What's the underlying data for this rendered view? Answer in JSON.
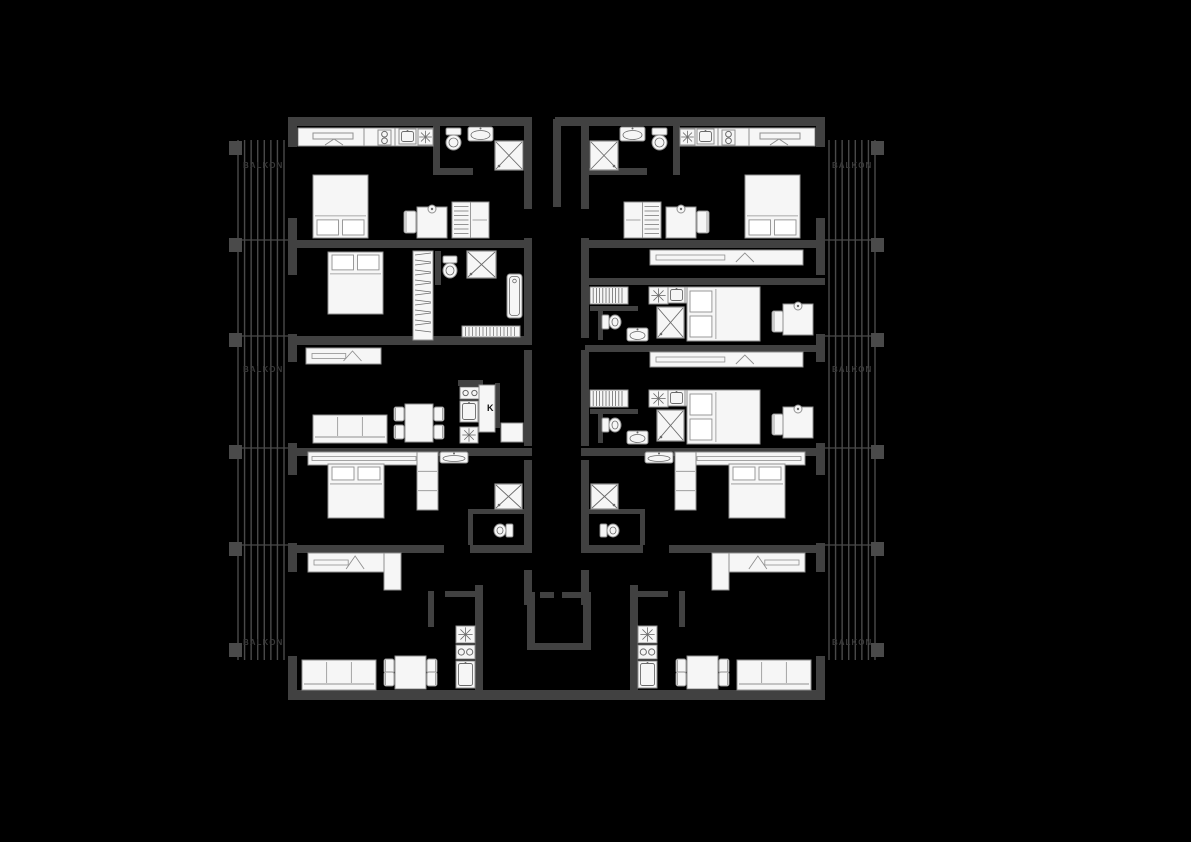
{
  "canvas": {
    "width": 1191,
    "height": 842,
    "background": "#000000"
  },
  "colors": {
    "wall": "#414141",
    "furniture_fill": "#f6f6f6",
    "furniture_stroke": "#909090",
    "detail": "#6a6a6a",
    "balcony_line": "#4a4a4a",
    "balcony_pier": "#4a4a4a",
    "faint_text": "#3a3a3a",
    "label_text": "#111111"
  },
  "mirror_sum": 1113,
  "balcony": {
    "x": 233,
    "y": 140,
    "w": 56,
    "h": 520,
    "n_lines": 8,
    "dividers": [
      240,
      336,
      448,
      545
    ],
    "piers_y": [
      141,
      238,
      333,
      445,
      542,
      643
    ],
    "labels": [
      {
        "text": "BALKON",
        "y": 168
      },
      {
        "text": "BALKON",
        "y": 372
      },
      {
        "text": "BALKON",
        "y": 645
      }
    ],
    "m": 1
  },
  "walls": [
    [
      288,
      117,
      244,
      9,
      1
    ],
    [
      555,
      117,
      30,
      9,
      0
    ],
    [
      288,
      240,
      244,
      8,
      1
    ],
    [
      288,
      336,
      244,
      9,
      0
    ],
    [
      288,
      448,
      244,
      8,
      1
    ],
    [
      288,
      545,
      156,
      8,
      1
    ],
    [
      470,
      545,
      62,
      8,
      1
    ],
    [
      288,
      690,
      537,
      10,
      0
    ],
    [
      288,
      117,
      9,
      30,
      1
    ],
    [
      288,
      218,
      9,
      57,
      1
    ],
    [
      288,
      334,
      9,
      28,
      1
    ],
    [
      288,
      443,
      9,
      32,
      1
    ],
    [
      288,
      543,
      9,
      29,
      1
    ],
    [
      288,
      656,
      9,
      44,
      1
    ],
    [
      524,
      117,
      8,
      92,
      1
    ],
    [
      524,
      238,
      8,
      100,
      1
    ],
    [
      524,
      350,
      8,
      96,
      1
    ],
    [
      524,
      460,
      8,
      92,
      1
    ],
    [
      524,
      570,
      8,
      35,
      1
    ],
    [
      433,
      117,
      7,
      58,
      1
    ],
    [
      433,
      168,
      40,
      7,
      0
    ],
    [
      585,
      168,
      62,
      7,
      0
    ],
    [
      435,
      251,
      6,
      34,
      0
    ],
    [
      458,
      380,
      25,
      6,
      0
    ],
    [
      495,
      383,
      5,
      45,
      0
    ],
    [
      468,
      509,
      58,
      5,
      1
    ],
    [
      468,
      514,
      5,
      31,
      1
    ],
    [
      445,
      591,
      32,
      6,
      1
    ],
    [
      428,
      591,
      6,
      36,
      1
    ],
    [
      475,
      585,
      8,
      115,
      1
    ],
    [
      585,
      278,
      240,
      7,
      0
    ],
    [
      585,
      345,
      240,
      7,
      0
    ],
    [
      590,
      306,
      48,
      5,
      0
    ],
    [
      598,
      311,
      5,
      29,
      0
    ],
    [
      590,
      409,
      48,
      5,
      0
    ],
    [
      598,
      414,
      5,
      29,
      0
    ],
    [
      553,
      119,
      8,
      88,
      0
    ],
    [
      527,
      592,
      8,
      57,
      0
    ],
    [
      583,
      592,
      8,
      57,
      0
    ],
    [
      527,
      643,
      64,
      7,
      0
    ],
    [
      540,
      592,
      14,
      6,
      0
    ],
    [
      562,
      592,
      21,
      6,
      0
    ]
  ],
  "furniture": [
    {
      "t": "counter",
      "x": 298,
      "y": 128,
      "w": 135,
      "h": 18,
      "divs": [
        66,
        97
      ],
      "m": 1
    },
    {
      "t": "slot",
      "x": 313,
      "y": 133,
      "w": 40,
      "h": 6,
      "m": 1
    },
    {
      "t": "chevron",
      "x": 325,
      "y": 139,
      "w": 18,
      "h": 6,
      "m": 1
    },
    {
      "t": "burners",
      "x": 378,
      "y": 130,
      "w": 13,
      "h": 15,
      "layout": "v",
      "m": 1
    },
    {
      "t": "sinkbox",
      "x": 399,
      "y": 129,
      "w": 17,
      "h": 15,
      "m": 1
    },
    {
      "t": "star",
      "x": 418,
      "y": 129,
      "w": 15,
      "h": 16,
      "m": 1
    },
    {
      "t": "bed",
      "x": 313,
      "y": 175,
      "w": 55,
      "h": 63,
      "head": "bottom",
      "m": 1
    },
    {
      "t": "chair",
      "x": 404,
      "y": 211,
      "w": 12,
      "h": 22,
      "m": 1
    },
    {
      "t": "desk",
      "x": 417,
      "y": 207,
      "w": 30,
      "h": 31,
      "m": 1
    },
    {
      "t": "wardrobe",
      "x": 452,
      "y": 202,
      "w": 37,
      "h": 36,
      "style": "hang",
      "m": 1
    },
    {
      "t": "toilet",
      "x": 445,
      "y": 128,
      "w": 17,
      "h": 24,
      "orient": "down",
      "m": 1
    },
    {
      "t": "sink",
      "x": 468,
      "y": 127,
      "w": 25,
      "h": 14,
      "m": 1
    },
    {
      "t": "shower",
      "x": 495,
      "y": 141,
      "w": 28,
      "h": 29,
      "m": 1
    },
    {
      "t": "bed",
      "x": 328,
      "y": 252,
      "w": 55,
      "h": 62,
      "head": "top",
      "m": 0
    },
    {
      "t": "wardrobe",
      "x": 413,
      "y": 251,
      "w": 20,
      "h": 89,
      "style": "zigzag",
      "m": 0
    },
    {
      "t": "toilet",
      "x": 442,
      "y": 256,
      "w": 16,
      "h": 24,
      "orient": "down",
      "m": 0
    },
    {
      "t": "shower",
      "x": 467,
      "y": 251,
      "w": 29,
      "h": 27,
      "m": 0
    },
    {
      "t": "bathtub",
      "x": 507,
      "y": 274,
      "w": 15,
      "h": 44,
      "m": 0
    },
    {
      "t": "radiator",
      "x": 462,
      "y": 326,
      "w": 58,
      "h": 11,
      "m": 0
    },
    {
      "t": "sideboard",
      "x": 306,
      "y": 348,
      "w": 75,
      "h": 16,
      "chev": 1,
      "m": 0
    },
    {
      "t": "sofa",
      "x": 313,
      "y": 415,
      "w": 74,
      "h": 28,
      "back": "bottom",
      "m": 0
    },
    {
      "t": "table",
      "x": 405,
      "y": 404,
      "w": 28,
      "h": 38,
      "m": 0
    },
    {
      "t": "burners",
      "x": 460,
      "y": 387,
      "w": 20,
      "h": 12,
      "layout": "h",
      "m": 0
    },
    {
      "t": "sinkbox",
      "x": 460,
      "y": 401,
      "w": 18,
      "h": 21,
      "m": 0
    },
    {
      "t": "star",
      "x": 460,
      "y": 427,
      "w": 18,
      "h": 16,
      "m": 0
    },
    {
      "t": "fridge",
      "x": 479,
      "y": 385,
      "w": 16,
      "h": 47,
      "m": 0
    },
    {
      "t": "box",
      "x": 501,
      "y": 423,
      "w": 22,
      "h": 19,
      "m": 0
    },
    {
      "t": "shelf",
      "x": 308,
      "y": 452,
      "w": 112,
      "h": 13,
      "m": 1
    },
    {
      "t": "bed",
      "x": 328,
      "y": 464,
      "w": 56,
      "h": 54,
      "head": "top",
      "m": 1
    },
    {
      "t": "wardrobe",
      "x": 417,
      "y": 452,
      "w": 21,
      "h": 58,
      "style": "cells",
      "m": 1
    },
    {
      "t": "sink",
      "x": 440,
      "y": 452,
      "w": 28,
      "h": 11,
      "m": 1
    },
    {
      "t": "shower",
      "x": 495,
      "y": 484,
      "w": 27,
      "h": 25,
      "m": 1
    },
    {
      "t": "toilet",
      "x": 492,
      "y": 523,
      "w": 21,
      "h": 15,
      "orient": "left",
      "m": 1
    },
    {
      "t": "sideboard",
      "x": 308,
      "y": 553,
      "w": 76,
      "h": 19,
      "chev": 1,
      "m": 1
    },
    {
      "t": "box",
      "x": 384,
      "y": 553,
      "w": 17,
      "h": 37,
      "m": 1
    },
    {
      "t": "sofa",
      "x": 302,
      "y": 660,
      "w": 74,
      "h": 30,
      "back": "bottom",
      "m": 1
    },
    {
      "t": "table",
      "x": 395,
      "y": 656,
      "w": 31,
      "h": 33,
      "m": 1
    },
    {
      "t": "star",
      "x": 456,
      "y": 626,
      "w": 19,
      "h": 17,
      "m": 1
    },
    {
      "t": "burners",
      "x": 456,
      "y": 645,
      "w": 19,
      "h": 14,
      "layout": "h",
      "m": 1
    },
    {
      "t": "sinkbox",
      "x": 456,
      "y": 661,
      "w": 19,
      "h": 27,
      "m": 1
    },
    {
      "t": "sideboard",
      "x": 650,
      "y": 250,
      "w": 153,
      "h": 15,
      "chev": 1,
      "m": 0
    },
    {
      "t": "sideboard",
      "x": 650,
      "y": 352,
      "w": 153,
      "h": 15,
      "chev": 1,
      "m": 0
    },
    {
      "t": "coatrack",
      "x": 590,
      "y": 287,
      "w": 38,
      "h": 17,
      "m": 0
    },
    {
      "t": "toilet",
      "x": 602,
      "y": 314,
      "w": 21,
      "h": 16,
      "orient": "right",
      "m": 0
    },
    {
      "t": "sink",
      "x": 627,
      "y": 328,
      "w": 21,
      "h": 13,
      "m": 0
    },
    {
      "t": "shower",
      "x": 657,
      "y": 307,
      "w": 27,
      "h": 31,
      "m": 0
    },
    {
      "t": "star",
      "x": 649,
      "y": 287,
      "w": 19,
      "h": 17,
      "m": 0
    },
    {
      "t": "sinkbox",
      "x": 668,
      "y": 287,
      "w": 17,
      "h": 16,
      "m": 0
    },
    {
      "t": "burners",
      "x": 685,
      "y": 287,
      "w": 13,
      "h": 16,
      "layout": "v",
      "m": 0
    },
    {
      "t": "bed",
      "x": 687,
      "y": 287,
      "w": 73,
      "h": 54,
      "head": "left",
      "m": 0
    },
    {
      "t": "chair",
      "x": 772,
      "y": 311,
      "w": 11,
      "h": 21,
      "m": 0
    },
    {
      "t": "desk",
      "x": 783,
      "y": 304,
      "w": 30,
      "h": 31,
      "m": 0
    },
    {
      "t": "coatrack",
      "x": 590,
      "y": 390,
      "w": 38,
      "h": 17,
      "m": 0
    },
    {
      "t": "toilet",
      "x": 602,
      "y": 417,
      "w": 21,
      "h": 16,
      "orient": "right",
      "m": 0
    },
    {
      "t": "sink",
      "x": 627,
      "y": 431,
      "w": 21,
      "h": 13,
      "m": 0
    },
    {
      "t": "shower",
      "x": 657,
      "y": 410,
      "w": 27,
      "h": 31,
      "m": 0
    },
    {
      "t": "star",
      "x": 649,
      "y": 390,
      "w": 19,
      "h": 17,
      "m": 0
    },
    {
      "t": "sinkbox",
      "x": 668,
      "y": 390,
      "w": 17,
      "h": 16,
      "m": 0
    },
    {
      "t": "burners",
      "x": 685,
      "y": 390,
      "w": 13,
      "h": 16,
      "layout": "v",
      "m": 0
    },
    {
      "t": "bed",
      "x": 687,
      "y": 390,
      "w": 73,
      "h": 54,
      "head": "left",
      "m": 0
    },
    {
      "t": "chair",
      "x": 772,
      "y": 414,
      "w": 11,
      "h": 21,
      "m": 0
    },
    {
      "t": "desk",
      "x": 783,
      "y": 407,
      "w": 30,
      "h": 31,
      "m": 0
    }
  ],
  "labels": [
    {
      "text": "K",
      "x": 487,
      "y": 411,
      "size": 9
    }
  ]
}
